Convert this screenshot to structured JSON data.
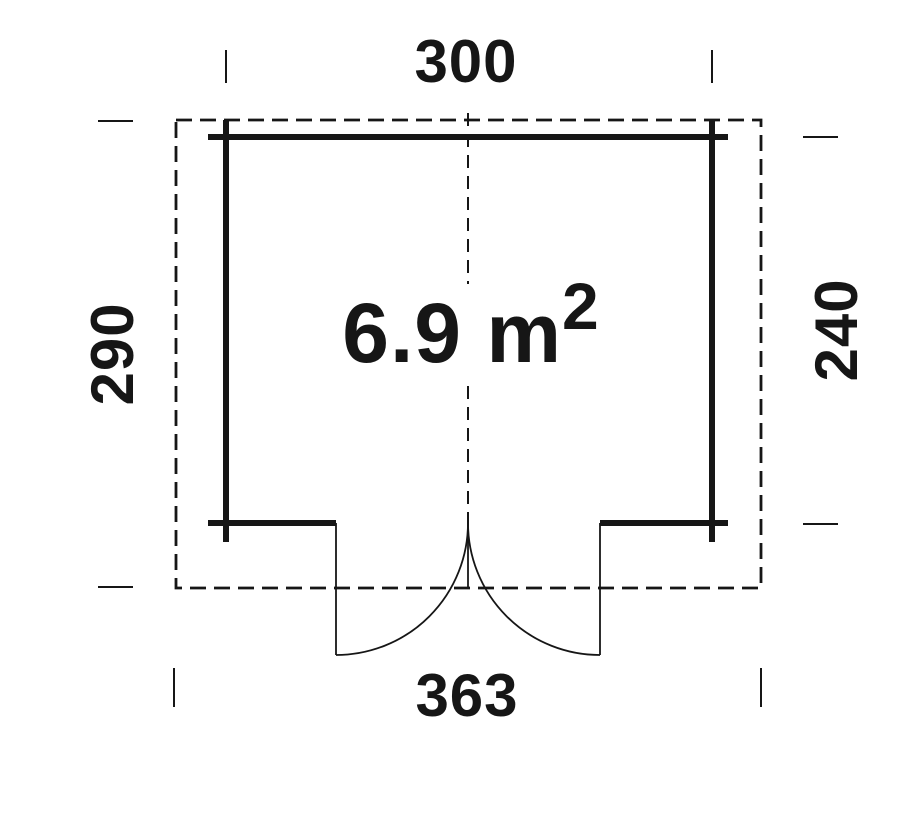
{
  "floor_plan": {
    "area_label": {
      "value": "6.9 m",
      "superscript": "2"
    },
    "dimensions": {
      "top_width": "300",
      "left_height": "290",
      "right_height": "240",
      "bottom_width": "363"
    },
    "colors": {
      "line": "#161616",
      "background": "#ffffff"
    }
  }
}
